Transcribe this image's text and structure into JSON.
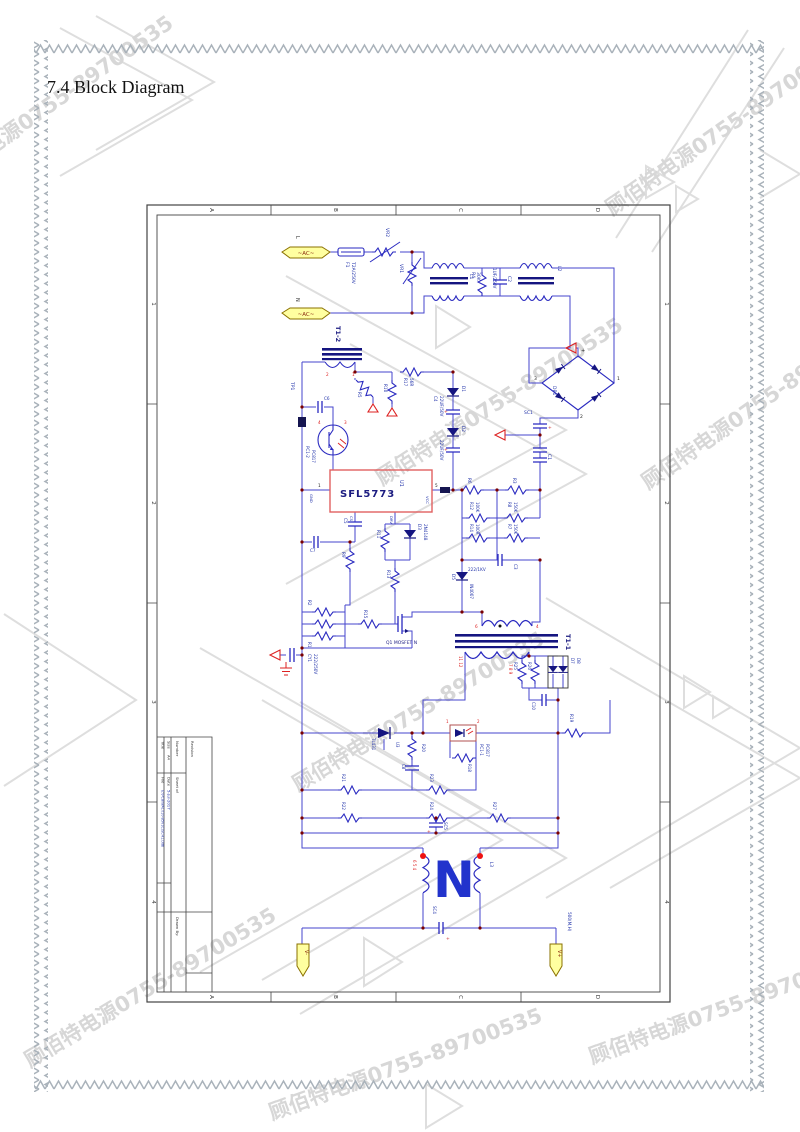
{
  "page": {
    "title": "7.4 Block Diagram"
  },
  "watermark": {
    "text": "顾佰特电源0755-89700535"
  },
  "frame": {
    "cols": [
      "A",
      "B",
      "C",
      "D"
    ],
    "rows": [
      "1",
      "2",
      "3",
      "4"
    ]
  },
  "titleblock": {
    "title": "Title",
    "size": "Size",
    "size_value": "A4",
    "number": "Number",
    "revision": "Revision",
    "date": "Date",
    "date_value": "5-Jul-2017",
    "file": "File",
    "file_value": "E:\\PCB\\WA1010-B5V1C\\SCH1.Ddb",
    "sheet": "Sheet of",
    "drawn": "Drawn By:"
  },
  "labels": {
    "l": "L",
    "n": "N",
    "ac1": "~AC~",
    "ac2": "~AC~",
    "f1": "F1",
    "f1v": "T2A/250V",
    "vr2": "VR2",
    "vr1": "VR1",
    "l1": "L1",
    "l2": "L2",
    "r4": "R4",
    "r4v": "30K",
    "c2": "C2",
    "c2v": "1UF/250V",
    "db1": "DB1",
    "p1": "1",
    "p2": "2",
    "p3": "3",
    "plus": "+",
    "sc1": "SC1",
    "t12": "T1-2",
    "t12p1": "1",
    "t12p2": "2",
    "tp1": "TP1",
    "c6": "C6",
    "pc12": "PC1-2",
    "pc12v": "PC817",
    "pc12p3": "3",
    "pc12p4": "4",
    "r17": "R17",
    "r17v": "56R",
    "r5": "R5",
    "r10": "R10",
    "d1": "D1",
    "d2": "D2",
    "c4": "C4",
    "c4v": "22UF/50V",
    "c4v2": "22UF/50V",
    "u1": "U1",
    "u1part": "SFL5773",
    "gnd": "GND",
    "vcc": "VCC",
    "cs": "CS",
    "drv": "DRV",
    "u1p1": "1",
    "u1p5": "5",
    "r6": "R6",
    "r3": "R3",
    "c1": "C1",
    "r12": "R12",
    "r12v": "100K",
    "r14": "R14",
    "r14v": "100R",
    "r8": "R8",
    "r8v": "150K",
    "r7": "R7",
    "r7v": "150K",
    "c3": "C3",
    "c3v": "222/1KV",
    "d5": "D5",
    "d5v": "IN4007",
    "c5": "C5",
    "c7": "C7",
    "r9": "R9",
    "r11": "R11",
    "d3": "D3",
    "d3v": "2N4148",
    "r13": "R13",
    "r15": "R15",
    "r1": "R1",
    "r2": "R2",
    "q1": "Q1 MOSFET N",
    "cy1": "CY1",
    "cy1v": "222/250V",
    "t11": "T1-1",
    "t11p6": "6",
    "t11p4": "4",
    "t11pa": "11 12",
    "t11pb": "7 8 9",
    "r25": "R25",
    "r26": "R26",
    "d7": "D7",
    "d8": "D8",
    "c10": "C10",
    "r19": "R19",
    "u3": "U3",
    "tl431": "TL431",
    "r20": "R20",
    "c8": "C8",
    "pc11": "PC1-1",
    "pc11v": "PC817",
    "pc11p1": "1",
    "pc11p2": "2",
    "r18": "R18",
    "r21": "R21",
    "r22": "R22",
    "r23": "R23",
    "r24": "R24",
    "sc5": "SC5",
    "r27": "R27",
    "sc4": "SC4",
    "sc4plus": "+",
    "l3": "L3",
    "wpins": "6 5 4",
    "bign": "N",
    "vminus": "V-",
    "vplus": "V+",
    "outnote": "500(M,H)"
  }
}
